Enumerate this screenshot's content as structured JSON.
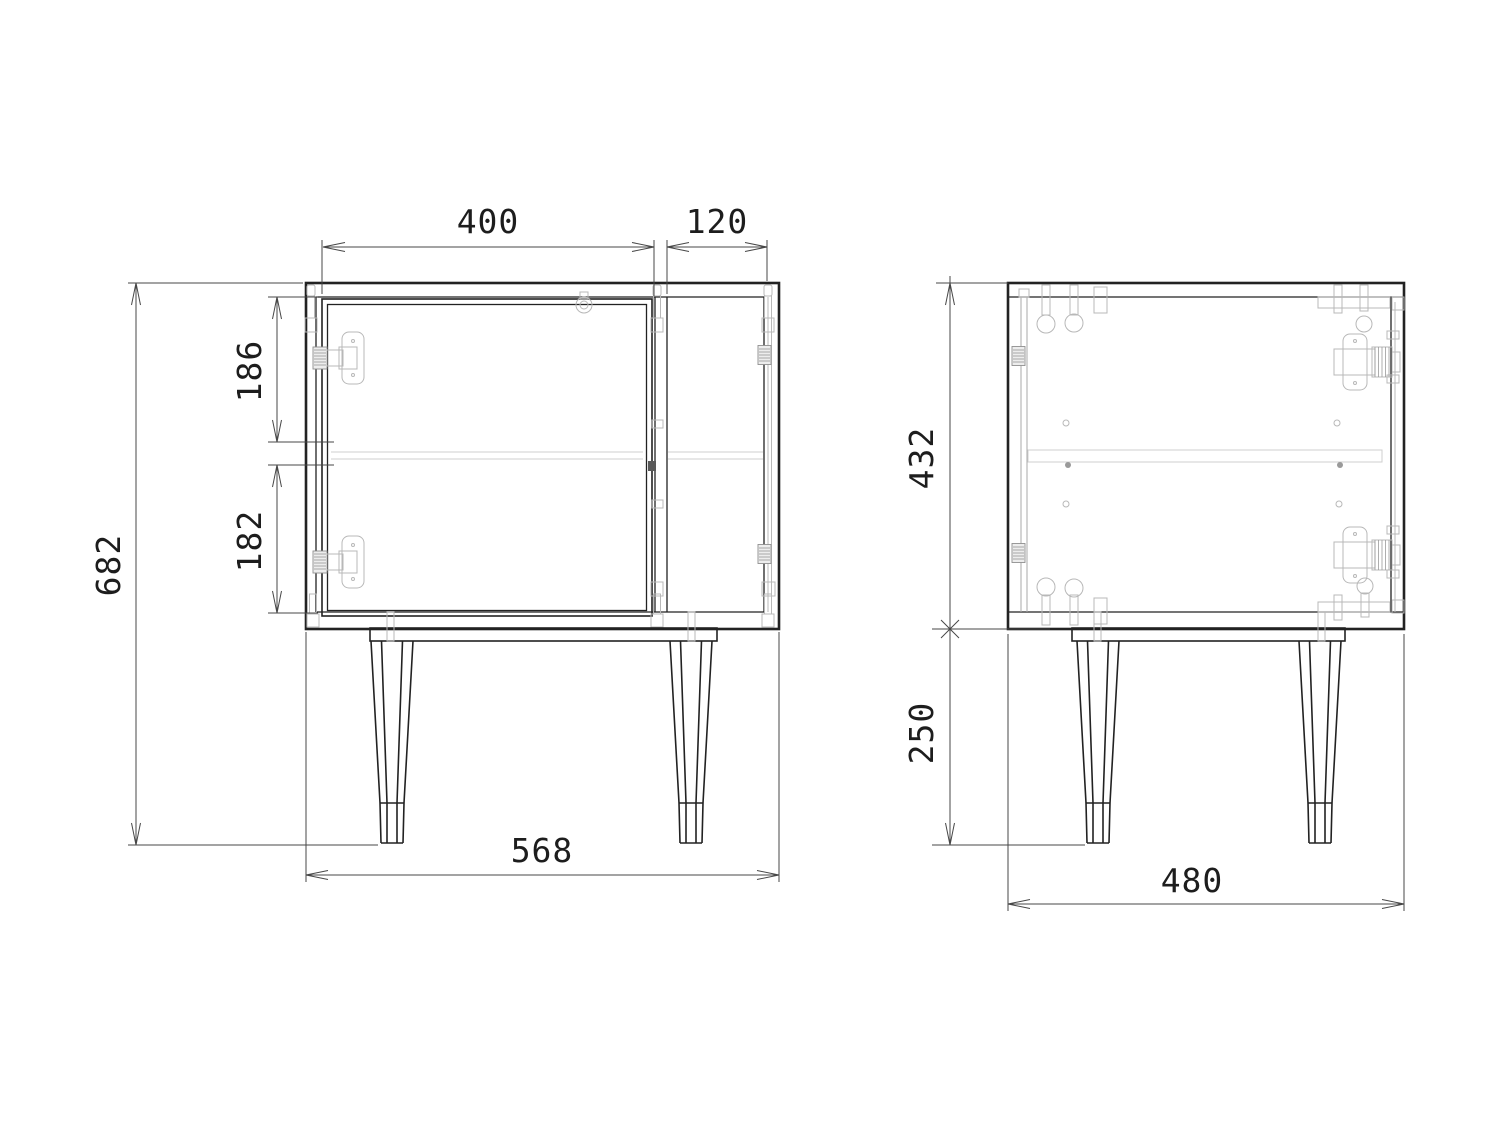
{
  "drawing": {
    "type": "furniture_orthographic_drawing",
    "colors": {
      "background": "#ffffff",
      "outline": "#222222",
      "hardware": "#b8b8b8",
      "hardware_dark": "#8f8f8f",
      "hidden_detail": "#cfcfcf",
      "dimension_line": "#474747",
      "dimension_text": "#1d1d1d"
    },
    "views": {
      "front": {
        "dims": {
          "door_width": "400",
          "bay_width": "120",
          "upper_opening_height": "186",
          "lower_opening_height": "182",
          "overall_height": "682",
          "overall_width": "568"
        }
      },
      "side": {
        "dims": {
          "carcass_height": "432",
          "leg_height": "250",
          "overall_depth": "480"
        }
      }
    }
  }
}
